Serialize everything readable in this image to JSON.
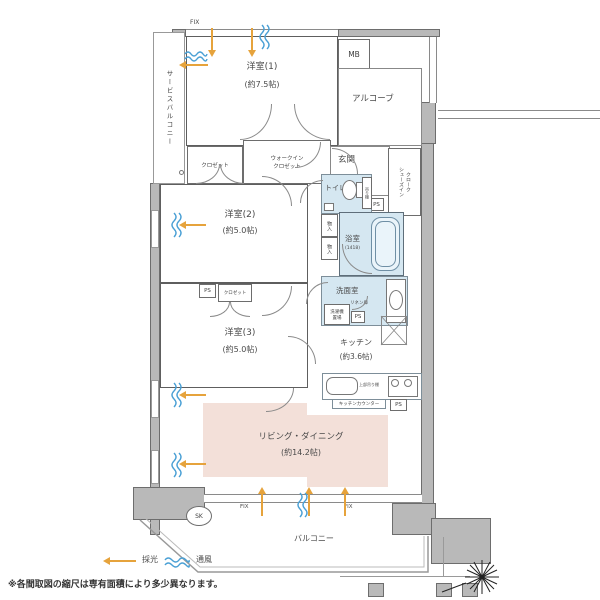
{
  "rooms": {
    "bedroom1": {
      "name": "洋室(1)",
      "size": "(約7.5帖)"
    },
    "bedroom2": {
      "name": "洋室(2)",
      "size": "(約5.0帖)"
    },
    "bedroom3": {
      "name": "洋室(3)",
      "size": "(約5.0帖)"
    },
    "living_dining": {
      "name": "リビング・ダイニング",
      "size": "(約14.2帖)"
    },
    "kitchen": {
      "name": "キッチン",
      "size": "(約3.6帖)"
    },
    "bathroom": {
      "name": "浴室",
      "size": "(1418)"
    },
    "washroom": {
      "name": "洗面室"
    },
    "toilet": {
      "name": "トイレ"
    },
    "entrance": {
      "name": "玄関"
    },
    "alcove": {
      "name": "アルコーブ"
    },
    "corridor": {
      "name": "廊下"
    },
    "service_balcony": {
      "name": "サービスバルコニー"
    },
    "balcony": {
      "name": "バルコニー"
    },
    "shoe_closet": {
      "line1": "シューズイン",
      "line2": "クローク"
    }
  },
  "storage": {
    "closet": "クロゼット",
    "wic_line1": "ウォークイン",
    "wic_line2": "クロゼット",
    "monoire": "物入",
    "linen": "リネン庫",
    "laundry_line1": "洗濯機",
    "laundry_line2": "置場",
    "shelf": "吊り棚",
    "upper_shelf": "上部吊り棚",
    "kitchen_counter": "キッチンカウンター"
  },
  "marks": {
    "mb": "MB",
    "ps": "PS",
    "fix": "FIX",
    "sk": "SK"
  },
  "legend": {
    "daylight": "採光",
    "ventilation": "通風"
  },
  "note": "※各間取図の縮尺は専有面積により多少異なります。",
  "colors": {
    "wall": "#b9b9b9",
    "wet_area": "#d5e7f1",
    "storage_area": "#ece7d6",
    "living_area": "#f3e0d9",
    "daylight_arrow": "#e6a33c",
    "ventilation_wave": "#4aa0d5"
  }
}
